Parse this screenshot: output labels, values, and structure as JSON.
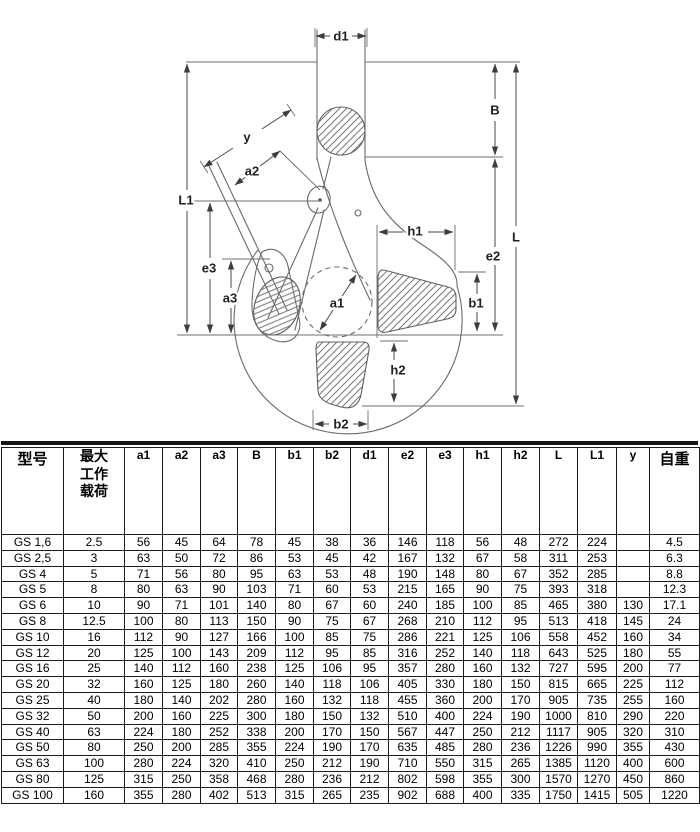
{
  "diagram": {
    "description": "clevis shortening grab hook technical drawing",
    "line_color": "#6a6a6a",
    "label_color": "#222222",
    "labels": [
      {
        "id": "d1",
        "text": "d1",
        "x": 341,
        "y": 36
      },
      {
        "id": "B",
        "text": "B",
        "x": 495,
        "y": 110
      },
      {
        "id": "L",
        "text": "L",
        "x": 516,
        "y": 237
      },
      {
        "id": "e2",
        "text": "e2",
        "x": 493,
        "y": 256
      },
      {
        "id": "L1",
        "text": "L1",
        "x": 186,
        "y": 200
      },
      {
        "id": "e3",
        "text": "e3",
        "x": 209,
        "y": 268
      },
      {
        "id": "a3",
        "text": "a3",
        "x": 230,
        "y": 298
      },
      {
        "id": "y",
        "text": "y",
        "x": 247,
        "y": 137
      },
      {
        "id": "a2",
        "text": "a2",
        "x": 252,
        "y": 171
      },
      {
        "id": "a1",
        "text": "a1",
        "x": 337,
        "y": 303
      },
      {
        "id": "h1",
        "text": "h1",
        "x": 415,
        "y": 231
      },
      {
        "id": "b1",
        "text": "b1",
        "x": 476,
        "y": 303
      },
      {
        "id": "h2",
        "text": "h2",
        "x": 398,
        "y": 370
      },
      {
        "id": "b2",
        "text": "b2",
        "x": 341,
        "y": 424
      }
    ]
  },
  "table": {
    "header": {
      "model": "型号",
      "load_lines": [
        "最大",
        "工作",
        "载荷"
      ],
      "dims": [
        "a1",
        "a2",
        "a3",
        "B",
        "b1",
        "b2",
        "d1",
        "e2",
        "e3",
        "h1",
        "h2",
        "L",
        "L1",
        "y"
      ],
      "weight": "自重"
    },
    "rows": [
      {
        "model": "GS 1,6",
        "load": "2.5",
        "values": [
          "56",
          "45",
          "64",
          "78",
          "45",
          "38",
          "36",
          "146",
          "118",
          "56",
          "48",
          "272",
          "224",
          ""
        ],
        "weight": "4.5"
      },
      {
        "model": "GS 2,5",
        "load": "3",
        "values": [
          "63",
          "50",
          "72",
          "86",
          "53",
          "45",
          "42",
          "167",
          "132",
          "67",
          "58",
          "311",
          "253",
          ""
        ],
        "weight": "6.3"
      },
      {
        "model": "GS 4",
        "load": "5",
        "values": [
          "71",
          "56",
          "80",
          "95",
          "63",
          "53",
          "48",
          "190",
          "148",
          "80",
          "67",
          "352",
          "285",
          ""
        ],
        "weight": "8.8"
      },
      {
        "model": "GS 5",
        "load": "8",
        "values": [
          "80",
          "63",
          "90",
          "103",
          "71",
          "60",
          "53",
          "215",
          "165",
          "90",
          "75",
          "393",
          "318",
          ""
        ],
        "weight": "12.3"
      },
      {
        "model": "GS 6",
        "load": "10",
        "values": [
          "90",
          "71",
          "101",
          "140",
          "80",
          "67",
          "60",
          "240",
          "185",
          "100",
          "85",
          "465",
          "380",
          "130"
        ],
        "weight": "17.1"
      },
      {
        "model": "GS 8",
        "load": "12.5",
        "values": [
          "100",
          "80",
          "113",
          "150",
          "90",
          "75",
          "67",
          "268",
          "210",
          "112",
          "95",
          "513",
          "418",
          "145"
        ],
        "weight": "24"
      },
      {
        "model": "GS 10",
        "load": "16",
        "values": [
          "112",
          "90",
          "127",
          "166",
          "100",
          "85",
          "75",
          "286",
          "221",
          "125",
          "106",
          "558",
          "452",
          "160"
        ],
        "weight": "34"
      },
      {
        "model": "GS 12",
        "load": "20",
        "values": [
          "125",
          "100",
          "143",
          "209",
          "112",
          "95",
          "85",
          "316",
          "252",
          "140",
          "118",
          "643",
          "525",
          "180"
        ],
        "weight": "55"
      },
      {
        "model": "GS 16",
        "load": "25",
        "values": [
          "140",
          "112",
          "160",
          "238",
          "125",
          "106",
          "95",
          "357",
          "280",
          "160",
          "132",
          "727",
          "595",
          "200"
        ],
        "weight": "77"
      },
      {
        "model": "GS 20",
        "load": "32",
        "values": [
          "160",
          "125",
          "180",
          "260",
          "140",
          "118",
          "106",
          "405",
          "330",
          "180",
          "150",
          "815",
          "665",
          "225"
        ],
        "weight": "112"
      },
      {
        "model": "GS 25",
        "load": "40",
        "values": [
          "180",
          "140",
          "202",
          "280",
          "160",
          "132",
          "118",
          "455",
          "360",
          "200",
          "170",
          "905",
          "735",
          "255"
        ],
        "weight": "160"
      },
      {
        "model": "GS 32",
        "load": "50",
        "values": [
          "200",
          "160",
          "225",
          "300",
          "180",
          "150",
          "132",
          "510",
          "400",
          "224",
          "190",
          "1000",
          "810",
          "290"
        ],
        "weight": "220"
      },
      {
        "model": "GS 40",
        "load": "63",
        "values": [
          "224",
          "180",
          "252",
          "338",
          "200",
          "170",
          "150",
          "567",
          "447",
          "250",
          "212",
          "1117",
          "905",
          "320"
        ],
        "weight": "310"
      },
      {
        "model": "GS 50",
        "load": "80",
        "values": [
          "250",
          "200",
          "285",
          "355",
          "224",
          "190",
          "170",
          "635",
          "485",
          "280",
          "236",
          "1226",
          "990",
          "355"
        ],
        "weight": "430"
      },
      {
        "model": "GS 63",
        "load": "100",
        "values": [
          "280",
          "224",
          "320",
          "410",
          "250",
          "212",
          "190",
          "710",
          "550",
          "315",
          "265",
          "1385",
          "1120",
          "400"
        ],
        "weight": "600"
      },
      {
        "model": "GS 80",
        "load": "125",
        "values": [
          "315",
          "250",
          "358",
          "468",
          "280",
          "236",
          "212",
          "802",
          "598",
          "355",
          "300",
          "1570",
          "1270",
          "450"
        ],
        "weight": "860"
      },
      {
        "model": "GS 100",
        "load": "160",
        "values": [
          "355",
          "280",
          "402",
          "513",
          "315",
          "265",
          "235",
          "902",
          "688",
          "400",
          "335",
          "1750",
          "1415",
          "505"
        ],
        "weight": "1220"
      }
    ]
  }
}
